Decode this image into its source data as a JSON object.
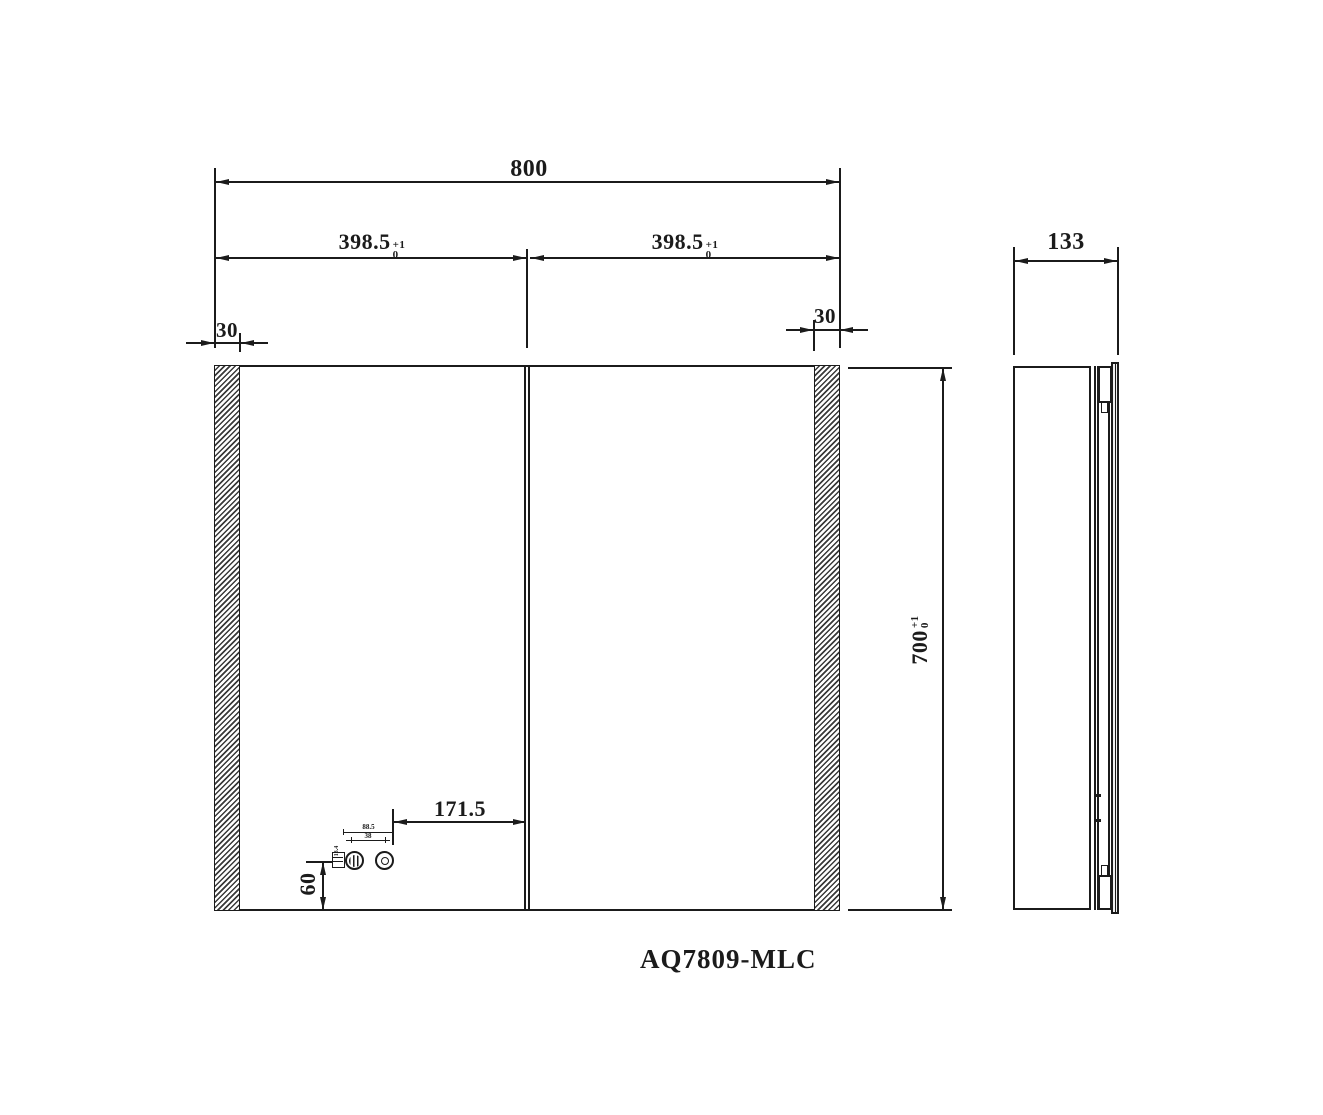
{
  "drawing": {
    "model": "AQ7809-MLC",
    "front": {
      "total_width": "800",
      "left_door": {
        "v": "398.5",
        "tp": "+1",
        "tb": "0"
      },
      "right_door": {
        "v": "398.5",
        "tp": "+1",
        "tb": "0"
      },
      "left_edge": "30",
      "right_edge": "30",
      "height": {
        "v": "700",
        "tp": "+1",
        "tb": "0"
      },
      "fixture_offset_x": "171.5",
      "fixture_offset_y": "60",
      "fixture_dim_top": "88.5",
      "fixture_dim_bottom": "38",
      "fixture_dim_left": "13.4"
    },
    "side": {
      "depth": "133"
    }
  }
}
